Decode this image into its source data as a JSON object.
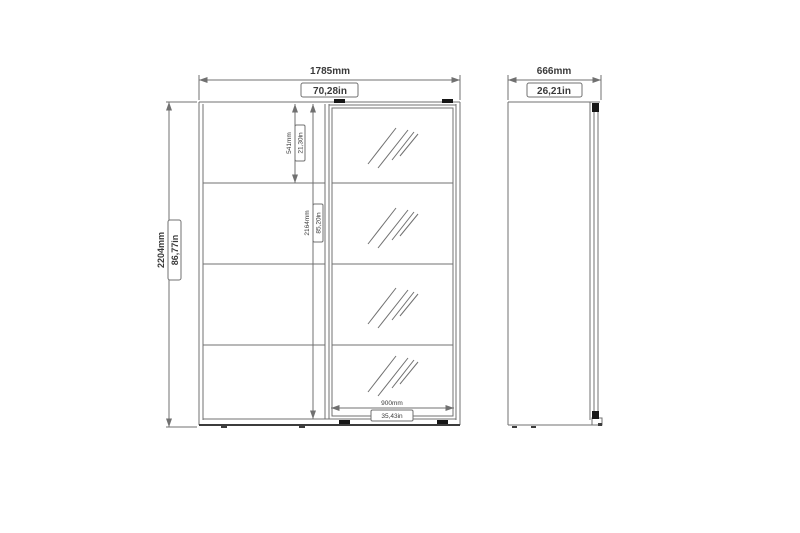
{
  "front_view": {
    "overall_width_mm": "1785mm",
    "overall_width_in": "70,28in",
    "overall_height_mm": "2204mm",
    "overall_height_in": "86,77in",
    "top_section_height_mm": "541mm",
    "top_section_height_in": "21,30in",
    "door_height_mm": "2164mm",
    "door_height_in": "85,20in",
    "mirror_door_width_mm": "900mm",
    "mirror_door_width_in": "35,43in"
  },
  "side_view": {
    "depth_mm": "666mm",
    "depth_in": "26,21in"
  },
  "colors": {
    "line": "#707070",
    "dark_line": "#3c3c3c",
    "text": "#3a3a3a",
    "background": "#ffffff"
  }
}
